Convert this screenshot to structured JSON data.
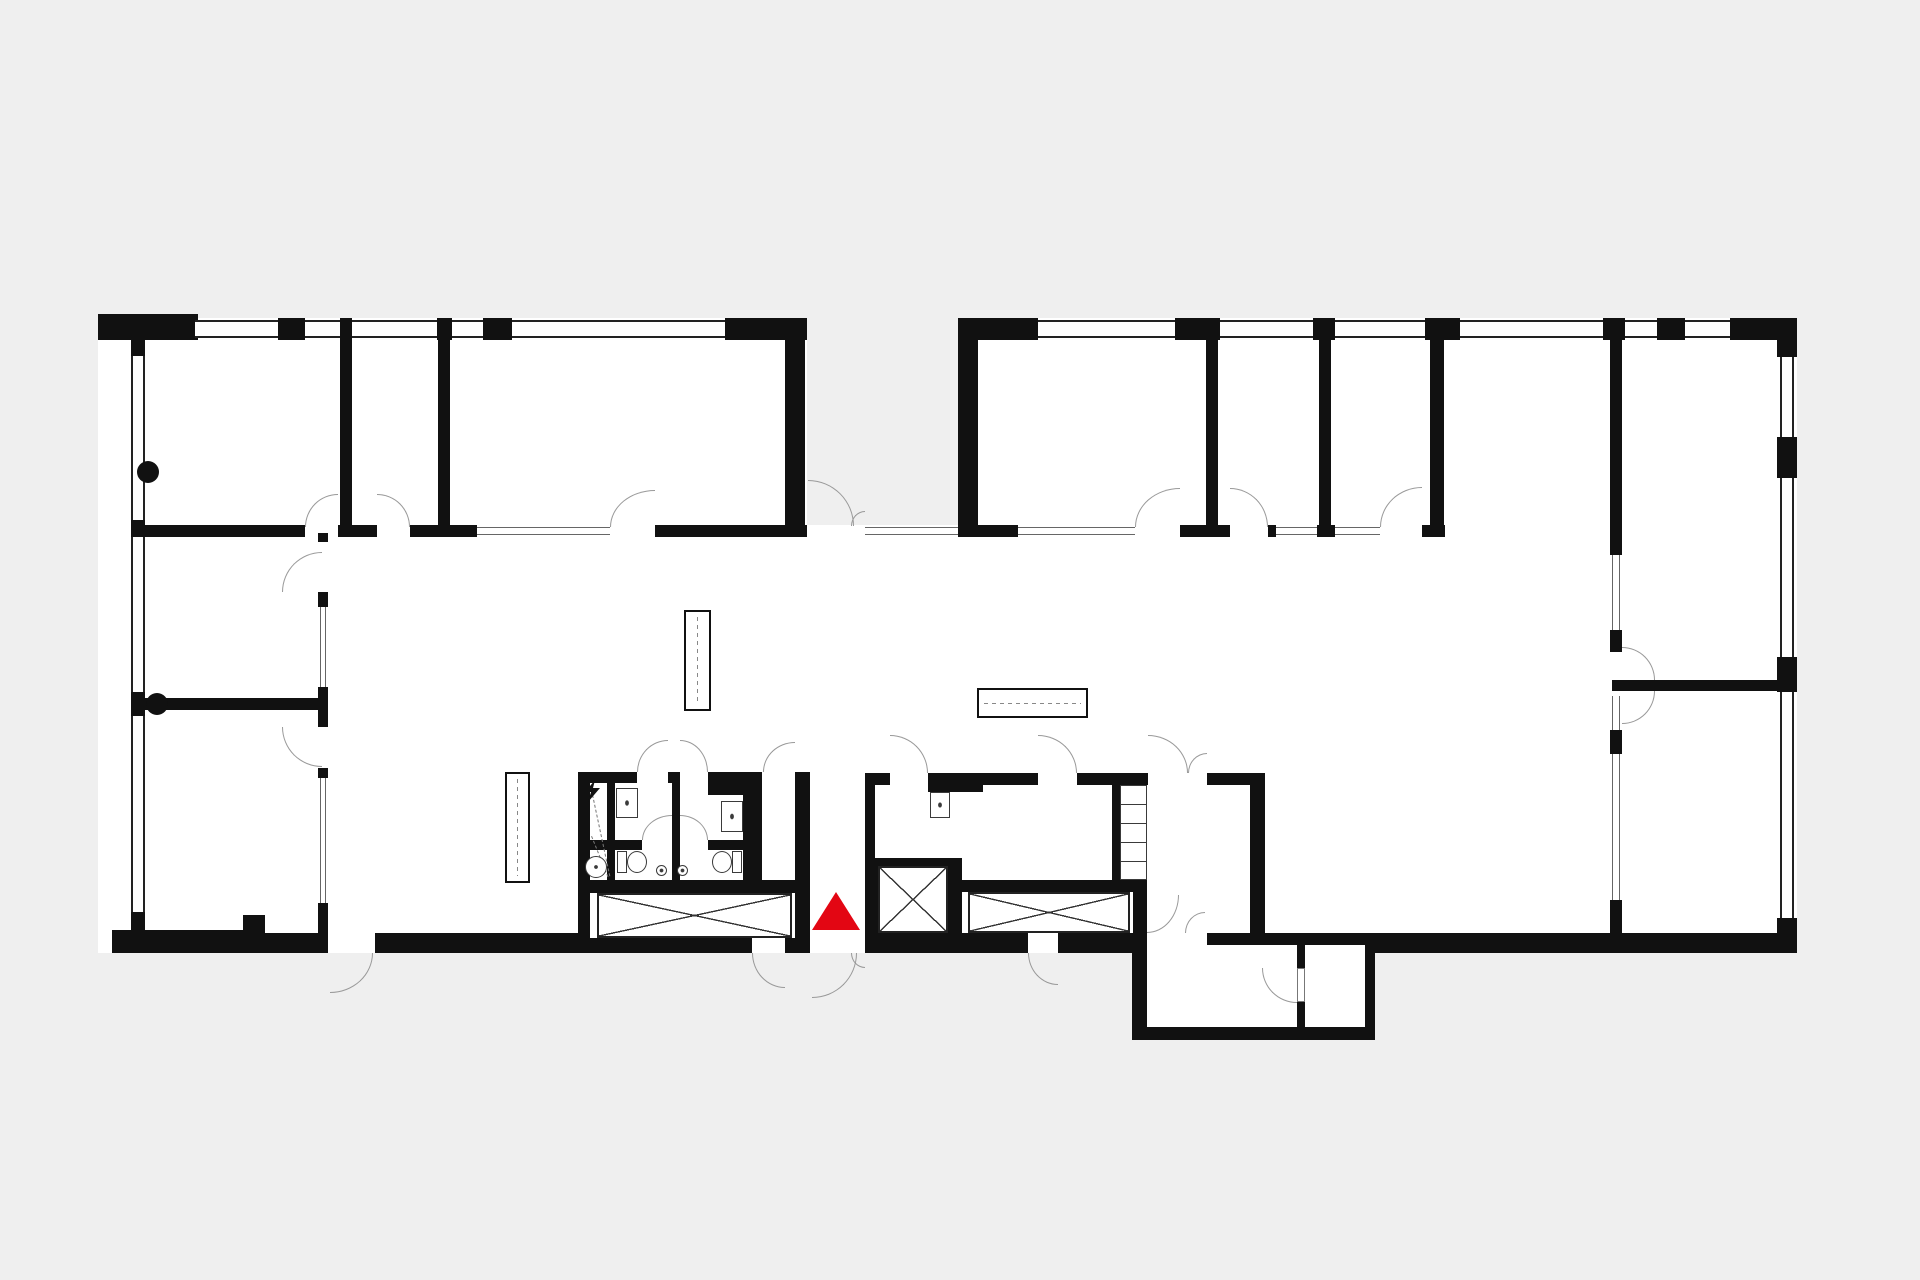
{
  "plan": {
    "type": "architectural-floor-plan",
    "visible_text": [],
    "colors": {
      "background": "#efefef",
      "floor": "#ffffff",
      "wall": "#111111",
      "window_line": "#222222",
      "interior_window_line": "#666666",
      "door_arc": "#999999",
      "fixture_line": "#3a3a3a",
      "marker_red": "#e30613"
    },
    "marker": {
      "shape": "triangle-up",
      "color": "#e30613",
      "location": "inside main entrance passage at south side of plan"
    },
    "symbols": [
      "wall-segment",
      "exterior-window-double-line",
      "interior-glazing",
      "door-swing-arc",
      "double-entrance-door",
      "elevator-cross-box",
      "stair-cross-box",
      "void-cross-box",
      "wc-toilet",
      "washbasin",
      "round-basin",
      "floor-drain",
      "electrical-bolt",
      "structural-column-dot",
      "shelf-unit",
      "dashed-bench"
    ]
  }
}
